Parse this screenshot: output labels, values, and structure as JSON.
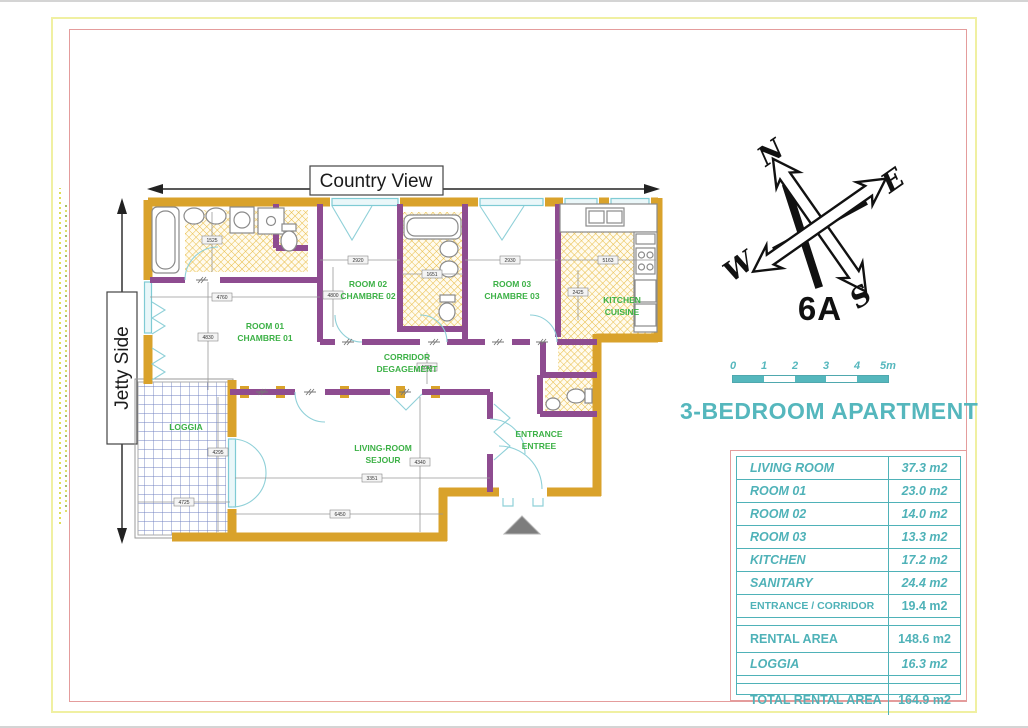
{
  "header": {
    "country_view": "Country View",
    "jetty_side": "Jetty Side"
  },
  "compass": {
    "north": "N",
    "east": "E",
    "south": "S",
    "west": "W"
  },
  "unit_number": "6A",
  "scale_bar": {
    "ticks": [
      "0",
      "1",
      "2",
      "3",
      "4",
      "5m"
    ]
  },
  "title": "3-BEDROOM APARTMENT",
  "plan": {
    "rooms": [
      {
        "name": "ROOM 01",
        "sub": "CHAMBRE 01"
      },
      {
        "name": "ROOM 02",
        "sub": "CHAMBRE 02"
      },
      {
        "name": "ROOM 03",
        "sub": "CHAMBRE 03"
      },
      {
        "name": "KITCHEN",
        "sub": "CUISINE"
      },
      {
        "name": "CORRIDOR",
        "sub": "DEGAGEMENT"
      },
      {
        "name": "ENTRANCE",
        "sub": "ENTREE"
      },
      {
        "name": "LIVING-ROOM",
        "sub": "SEJOUR"
      },
      {
        "name": "LOGGIA",
        "sub": ""
      }
    ],
    "dims": [
      "4760",
      "4830",
      "2920",
      "4800",
      "2930",
      "1651",
      "5163",
      "2425",
      "1035",
      "4340",
      "3351",
      "6450",
      "4725",
      "4295",
      "1525"
    ]
  },
  "area_table": {
    "rows": [
      {
        "label": "LIVING ROOM",
        "value": "37.3 m2"
      },
      {
        "label": "ROOM 01",
        "value": "23.0 m2"
      },
      {
        "label": "ROOM 02",
        "value": "14.0 m2"
      },
      {
        "label": "ROOM 03",
        "value": "13.3 m2"
      },
      {
        "label": "KITCHEN",
        "value": "17.2 m2"
      },
      {
        "label": "SANITARY",
        "value": "24.4 m2"
      },
      {
        "label": "ENTRANCE / CORRIDOR",
        "value": "19.4 m2"
      },
      {
        "label": "RENTAL AREA",
        "value": "148.6 m2"
      },
      {
        "label": "LOGGIA",
        "value": "16.3 m2"
      },
      {
        "label": "TOTAL RENTAL AREA",
        "value": "164.9 m2"
      }
    ]
  },
  "colors": {
    "teal": "#4FB2B8",
    "wall_orange": "#D9A22B",
    "wall_purple": "#8E4C90",
    "label_green": "#3CB146",
    "border_pink": "#E49C9C",
    "border_yellow": "#F0F0A2",
    "window_blue": "#8FD0D8",
    "tile_yellow": "#E9BE4B",
    "loggia_grid_blue": "#7080C0"
  }
}
